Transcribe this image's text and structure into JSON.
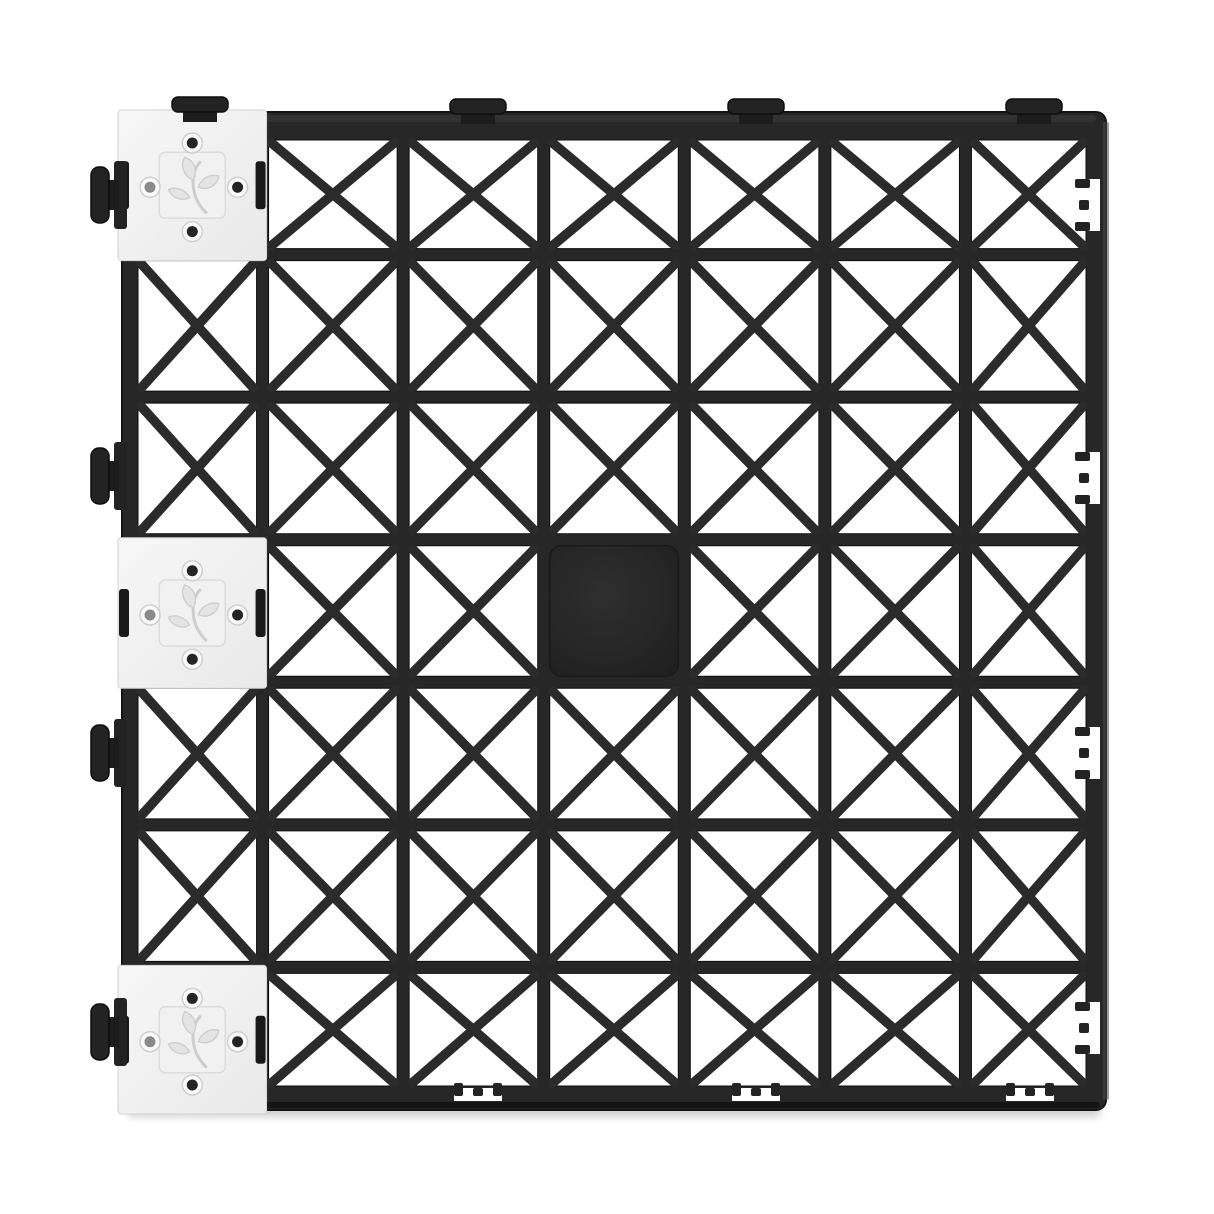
{
  "canvas": {
    "width": 1214,
    "height": 1214,
    "background": "#ffffff"
  },
  "tile": {
    "x": 122,
    "y": 112,
    "width": 984,
    "height": 998,
    "rows": 7,
    "cols": 7,
    "rim_inset": {
      "top": 28,
      "left": 16,
      "right": 20,
      "bottom": 24
    },
    "divider": 12,
    "corner_radius": 10,
    "colors": {
      "body": "#272727",
      "body_top_highlight": "#343434",
      "body_bottom_lip": "#141414",
      "side_face": "#4a4a4a",
      "brace": "#2b2b2b",
      "cell_fill": "#ffffff",
      "cell_outline": "#0d0d0d",
      "connector_fill": "#232323",
      "connector_dark": "#1c1c1c",
      "connector_stroke": "#0d0d0d",
      "shadow": "#000000"
    }
  },
  "cells": {
    "solid_center": {
      "row": 3,
      "col": 3,
      "fill_center": "#2f2f2f",
      "fill_edge": "#202020",
      "radius": 12
    },
    "inserts": [
      {
        "row": 0,
        "col": 0
      },
      {
        "row": 3,
        "col": 0
      },
      {
        "row": 6,
        "col": 0
      }
    ]
  },
  "insert_style": {
    "fill_light": "#f7f7f7",
    "fill_dark": "#e9e9e9",
    "edge": "#d2d2d2",
    "plate_fill": "#f1f1f1",
    "plate_edge": "#dcdcdc",
    "plate_size": 66,
    "logo_icon": "leaf-sprig-icon",
    "leaf_fill": "#e4e4e4",
    "leaf_edge": "#cccccc",
    "stem_color": "#cdcdcd",
    "hole_ring": "#cfcfcf",
    "hole_outer": "#fafafa",
    "hole_fill": "#242424",
    "hole_fill_light": "#8a8a8a",
    "slot_fill": "#191919"
  },
  "connectors": {
    "top_tabs_x": [
      200,
      478,
      756,
      1034
    ],
    "left_knobs_y": [
      195,
      476,
      753,
      1032
    ],
    "right_notches_y": [
      205,
      478,
      753,
      1028
    ],
    "bottom_notches_x": [
      478,
      756,
      1030
    ]
  }
}
